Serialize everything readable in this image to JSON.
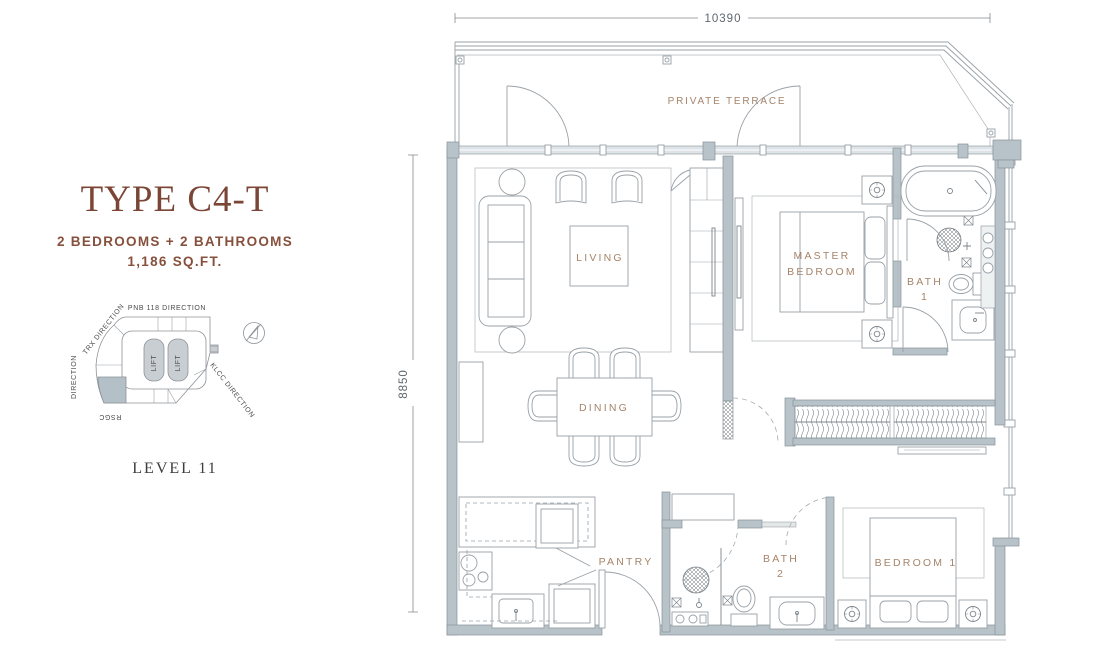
{
  "colors": {
    "wall_fill": "#b7c2c9",
    "wall_stroke": "#89939a",
    "furniture_line": "#99a1a7",
    "room_label": "#a5846a",
    "title_brown": "#7b4636",
    "subtitle_brown": "#86503c",
    "dimension_text": "#5f666c"
  },
  "left_panel": {
    "title": "TYPE C4-T",
    "subtitle": "2 BEDROOMS + 2 BATHROOMS",
    "area": "1,186 SQ.FT.",
    "level": "LEVEL 11",
    "key_plan": {
      "pnb": "PNB 118 DIRECTION",
      "trx": "TRX DIRECTION",
      "left_direction": "DIRECTION",
      "rsgc": "RSGC",
      "klcc": "KLCC DIRECTION",
      "lift": "LIFT"
    }
  },
  "plan": {
    "dim_top": "10390",
    "dim_left": "8850",
    "labels": {
      "terrace": "PRIVATE TERRACE",
      "living": "LIVING",
      "dining": "DINING",
      "pantry": "PANTRY",
      "master_line1": "MASTER",
      "master_line2": "BEDROOM",
      "bath1_line1": "BATH",
      "bath1_line2": "1",
      "bath2_line1": "BATH",
      "bath2_line2": "2",
      "bedroom1": "BEDROOM 1"
    }
  }
}
